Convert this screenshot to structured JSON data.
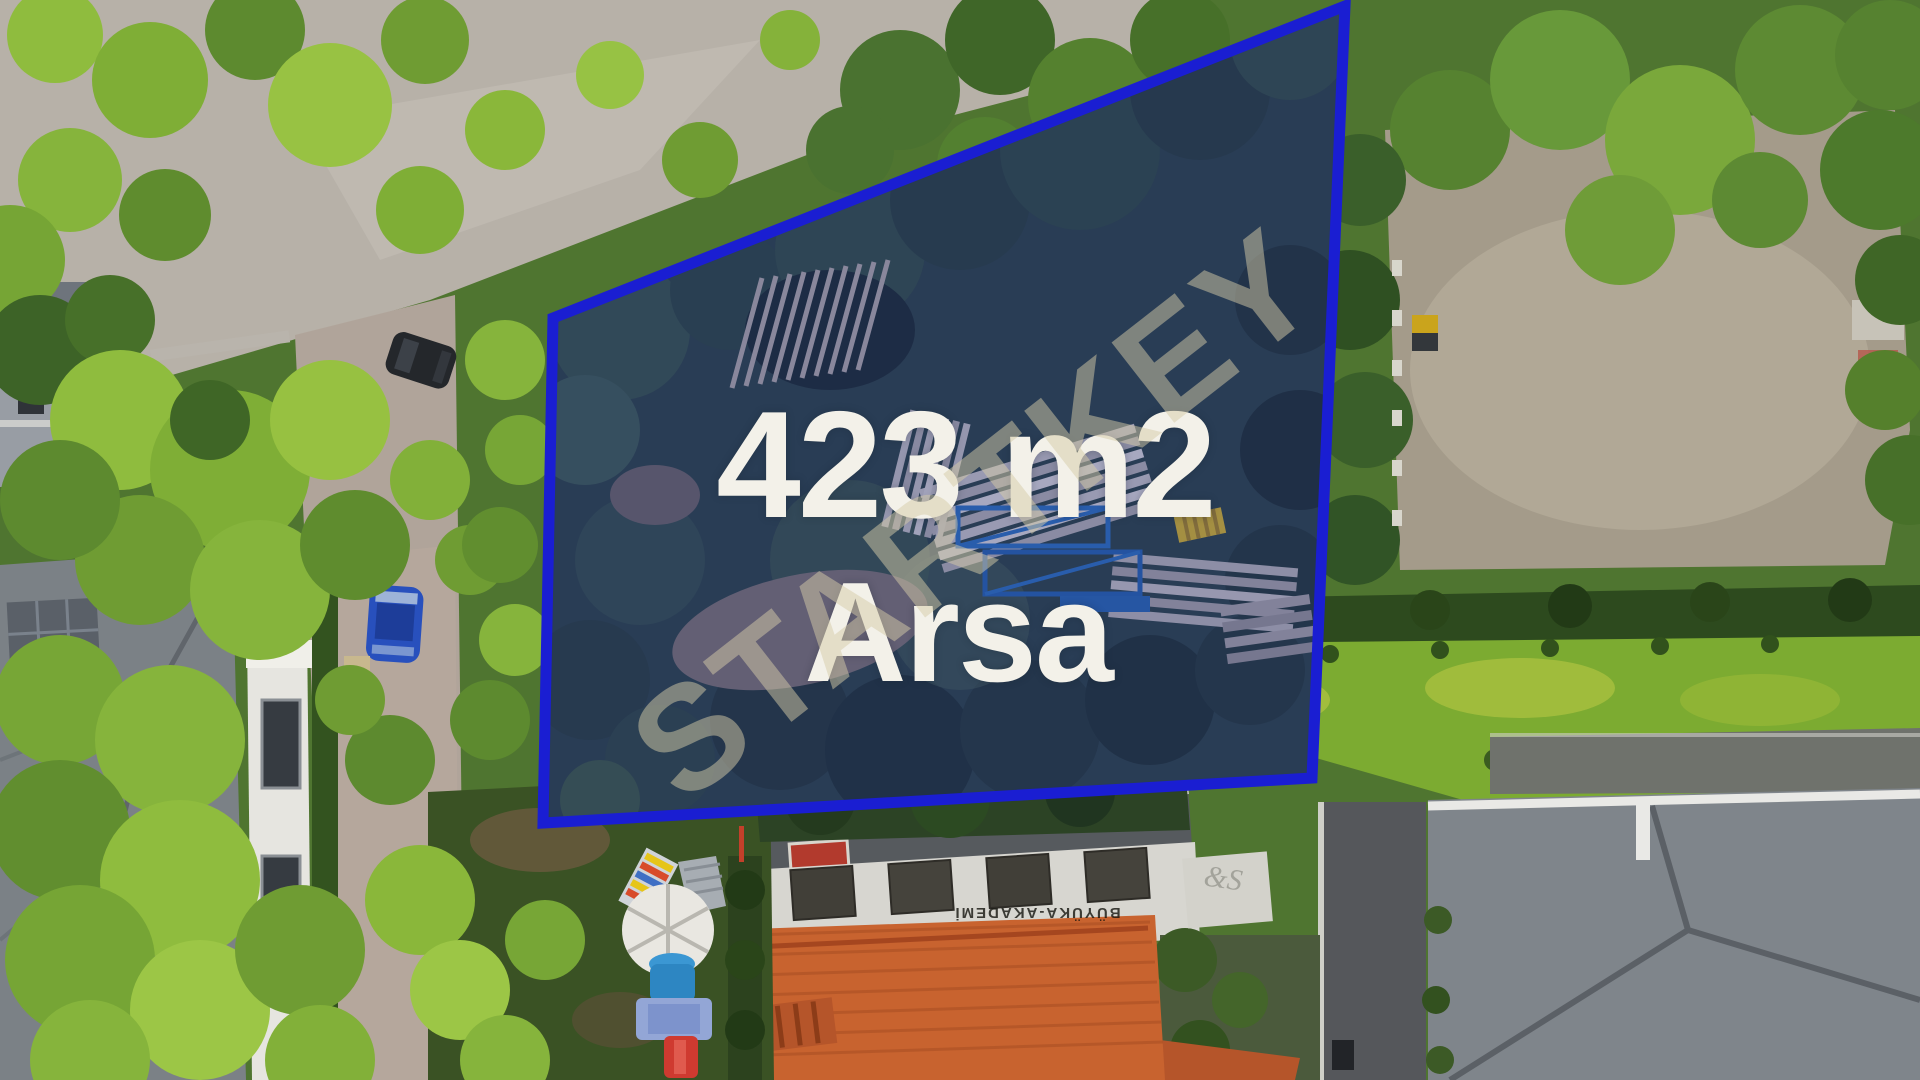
{
  "scene": {
    "description": "Aerial drone photo of a residential neighborhood; a vacant tree-covered land parcel is outlined in blue",
    "parcel": {
      "area_label": "423 m2",
      "type_label": "Arsa"
    },
    "watermark": {
      "text": "STARTKEY",
      "color": "rgba(214,204,168,0.5)"
    },
    "signs": {
      "rooftop_sign": "BÜYÜKA-AKADEMİ",
      "wall_decor": "&S"
    },
    "colors": {
      "parcel_outline": "#1a1ed2",
      "parcel_tint": "rgba(30,35,150,0.28)",
      "label_text": "#f3f1e9"
    }
  }
}
